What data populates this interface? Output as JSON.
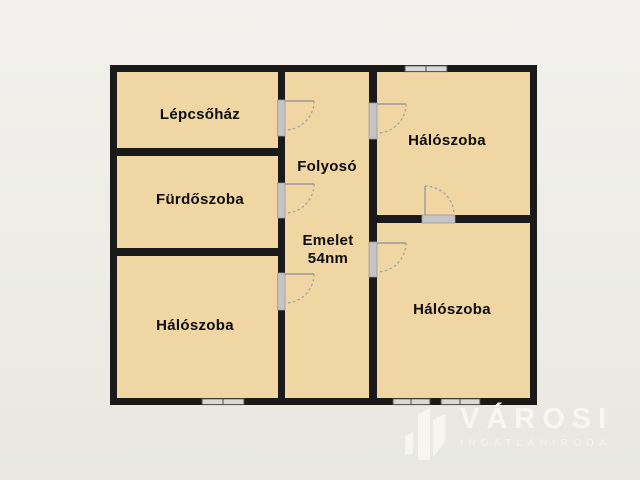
{
  "plan": {
    "rooms": [
      {
        "id": "staircase",
        "label": "Lépcsőház"
      },
      {
        "id": "bathroom",
        "label": "Fürdőszoba"
      },
      {
        "id": "bedroom-bottom-left",
        "label": "Hálószoba"
      },
      {
        "id": "hallway",
        "label": "Folyosó"
      },
      {
        "id": "bedroom-top-right",
        "label": "Hálószoba"
      },
      {
        "id": "bedroom-bottom-right",
        "label": "Hálószoba"
      }
    ],
    "floor_title": "Emelet",
    "floor_area": "54nm",
    "door_count": 6,
    "window_count": 4
  },
  "watermark": {
    "brand": "VÁROSI",
    "subtitle": "INGATLANIRODA"
  },
  "colors": {
    "background": "#edece7",
    "wall": "#1a1a1a",
    "room_fill": "#f0d6a3",
    "door_sill": "#c4c4c4",
    "door_arc": "#9a9a9a",
    "window_fill": "#d8d8d8",
    "window_frame": "#4a4a4a",
    "label_text": "#0d0d0d",
    "watermark_text": "#f7f6f3"
  }
}
